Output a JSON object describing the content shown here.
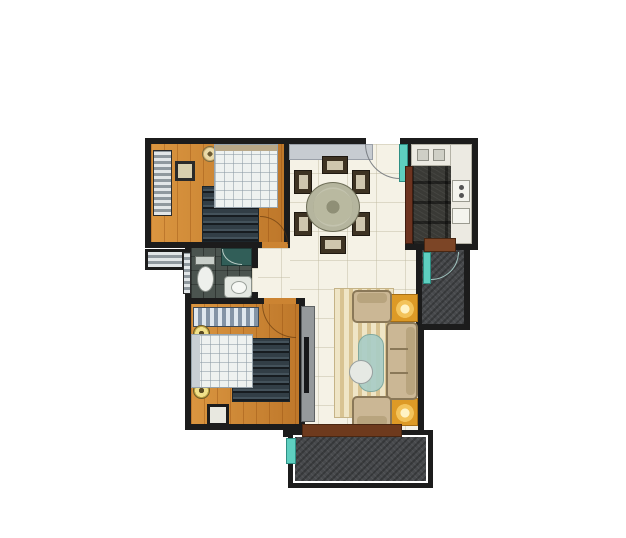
{
  "title": "two-bedroom apartment floor plan",
  "background_color": "#ffffff",
  "palette": {
    "wall": "#1c1c1c",
    "wood_floor": "#cc8432",
    "tile_floor": "#f5f2e6",
    "balcony_floor": "#47494c",
    "bathroom_floor": "#4b544f",
    "granite_counter": "#3a3a36",
    "door_teal": "#5ecfc0",
    "threshold_brown": "#6e3a1d",
    "sofa_beige": "#cbb795",
    "lamp_table_yellow": "#dd9a26",
    "rug_cream": "#efe5c6",
    "dark_rug": "#323e46"
  },
  "rooms": [
    {
      "id": "bedroom-main",
      "floor": "orange wood",
      "items": [
        "slatted wardrobe",
        "nightstand",
        "two bedside lamps",
        "double bed with quilt",
        "dark floor rug",
        "inward swinging door"
      ]
    },
    {
      "id": "dining-area",
      "floor": "cream tile",
      "items": [
        "entry cabinet",
        "entrance door with swing arc",
        "round dining table",
        "six chairs"
      ]
    },
    {
      "id": "kitchen",
      "floor": "tile",
      "items": [
        "sink unit",
        "granite worktop",
        "hob unit",
        "tall cabinet column",
        "brown sliding door",
        "service doorway"
      ]
    },
    {
      "id": "utility-balcony",
      "floor": "dark textured",
      "items": [
        "teal service door with swing arc"
      ]
    },
    {
      "id": "bathroom",
      "floor": "dark tile",
      "items": [
        "shower corner",
        "toilet",
        "washbasin",
        "louver window"
      ]
    },
    {
      "id": "corridor",
      "floor": "cream tile",
      "items": []
    },
    {
      "id": "bedroom-second",
      "floor": "orange wood",
      "items": [
        "striped headboard dresser",
        "two bedside lamps",
        "double bed with quilt",
        "dark floor rug",
        "stool",
        "inward swinging door"
      ]
    },
    {
      "id": "living-room",
      "floor": "cream tile",
      "items": [
        "tv cabinet",
        "striped area rug",
        "coffee table decor",
        "three-seat sofa",
        "two armchairs",
        "two yellow lamp side tables",
        "balcony threshold"
      ]
    },
    {
      "id": "balcony",
      "floor": "dark textured",
      "items": [
        "teal door edge"
      ]
    },
    {
      "id": "ac-platform",
      "floor": "slatted",
      "items": []
    }
  ]
}
